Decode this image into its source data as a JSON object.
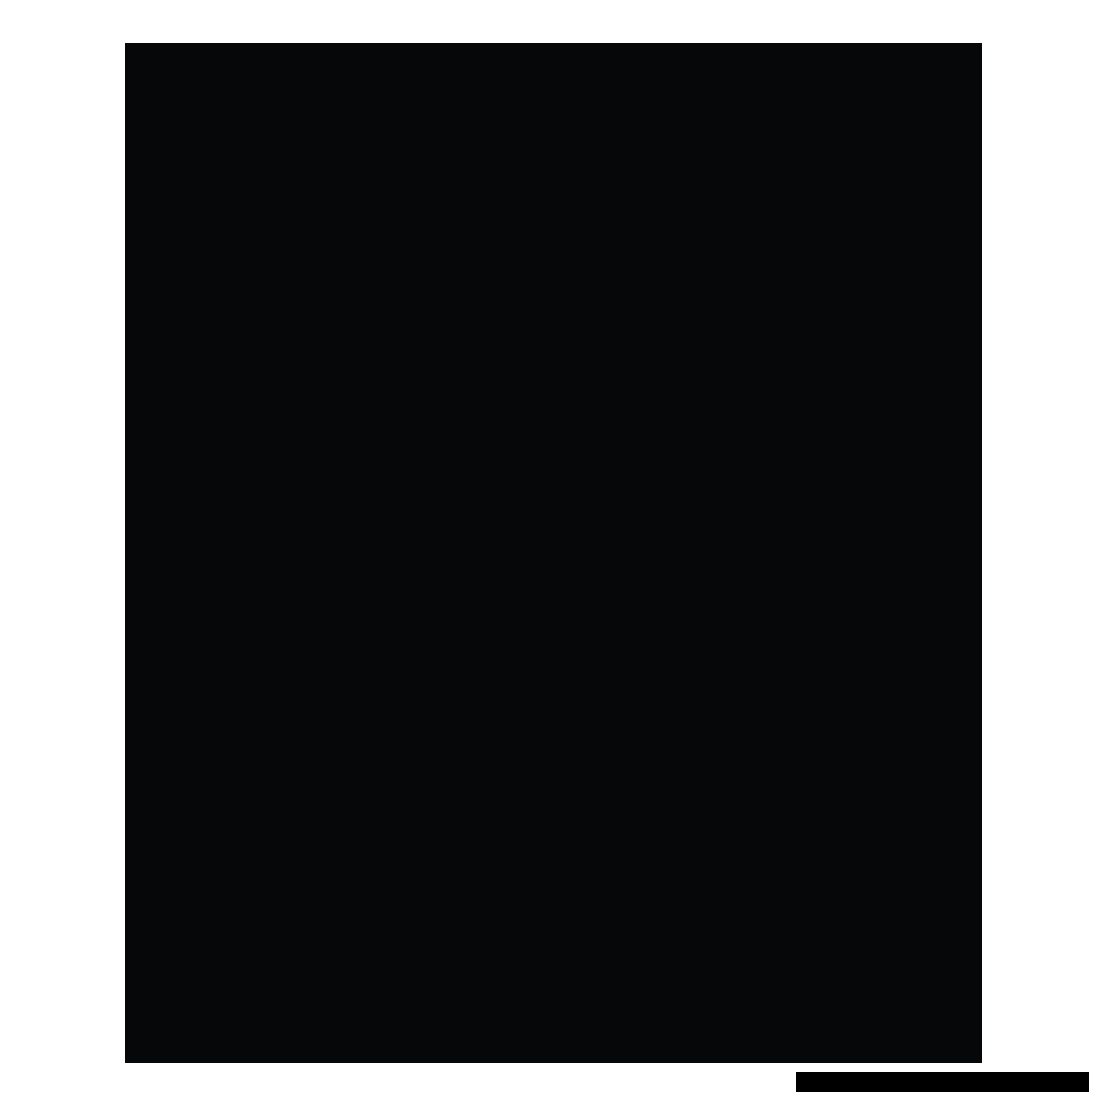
{
  "page": {
    "background_color": "#ffffff"
  },
  "content_panel": {
    "color": "#050708"
  },
  "bottom_bar": {
    "color": "#000000"
  }
}
